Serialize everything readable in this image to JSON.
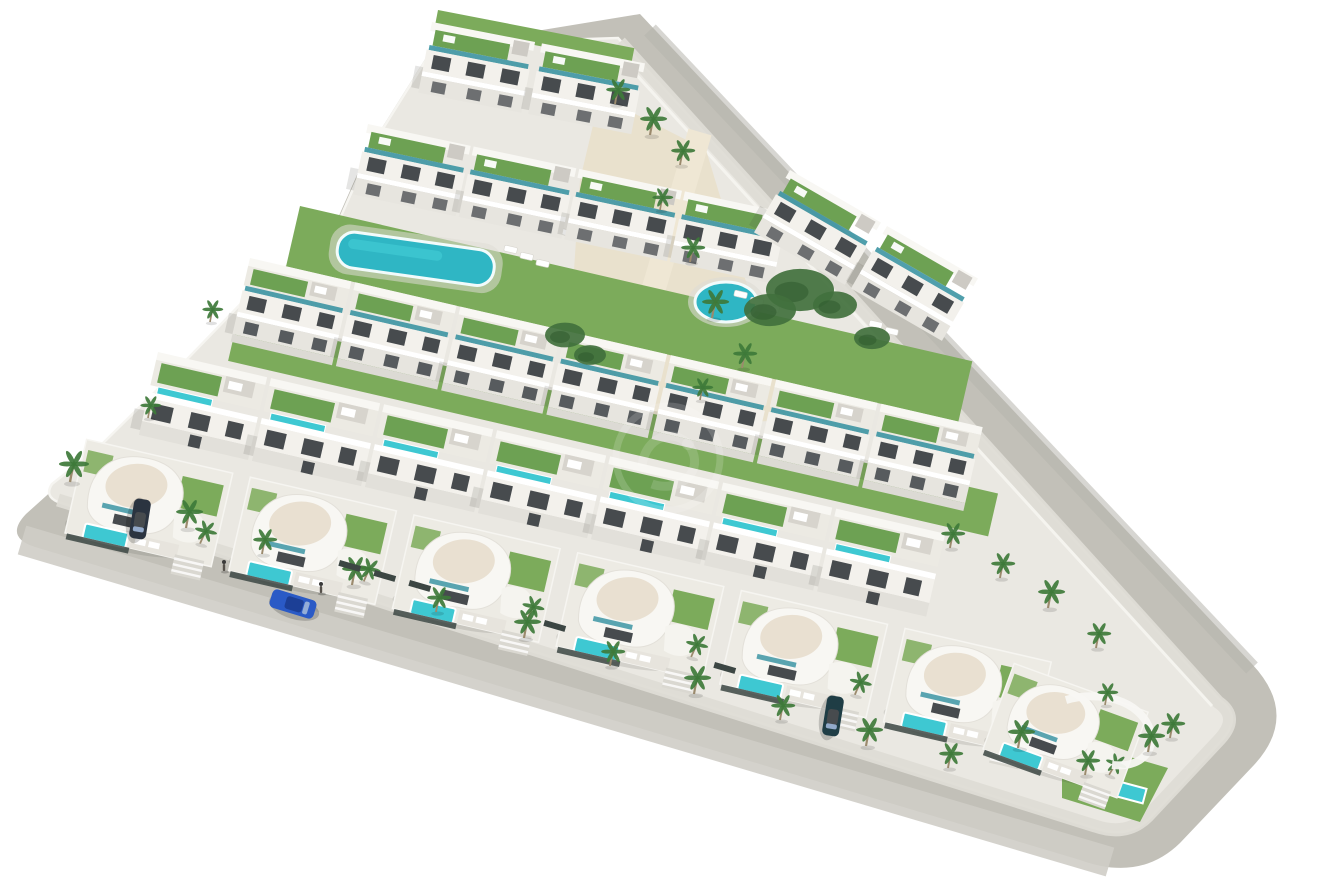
{
  "meta": {
    "title": "Aerial 3D architectural render of a triangular coastal residential development with white villas, green roof terraces, communal pools and perimeter roads",
    "canvas": {
      "w": 1320,
      "h": 895
    },
    "background": "#ffffff"
  },
  "palette": {
    "background": "#ffffff",
    "road_base": "#c2c0b8",
    "road_light": "#cfcdc6",
    "road_dark": "#b7b5ad",
    "sidewalk": "#dedcd5",
    "curb_white": "#f6f5f1",
    "platform": "#eae8e2",
    "building_white": "#f8f7f3",
    "facade_light": "#f3f1ec",
    "facade_mid": "#e7e5df",
    "facade_base": "#dcdad4",
    "stair_gray": "#cdcac4",
    "window_dark": "#474b4e",
    "window_mid": "#575b5e",
    "glass_teal": "#3d95a3",
    "roof_green": "#6da153",
    "lawn": "#7cab5b",
    "lawn_dark": "#41703d",
    "hedge_dark": "#3c4643",
    "pool": "#3ec8d2",
    "pool_deep": "#2fb6c4",
    "pool_rim": "#f2fbfb",
    "sand": "#e8dfc9",
    "walkway_sand": "#efe7d4",
    "cream_roof": "#e9e0d1",
    "palm_green": "#3e7a3a",
    "palm_trunk": "#9b8a6d",
    "car_blue_body": "#2a5ac6",
    "car_blue_roof": "#1c3f96",
    "car_glass": "#9fb6d8",
    "parked_car_1": "#2b3440",
    "parked_car_2": "#1f3d45",
    "shadow": "rgba(70,70,64,0.14)",
    "watermark": "#ffffff"
  },
  "scene": {
    "base": {
      "ring_outline": "M 640 14 L 1252 664 Q 1300 715 1254 765 L 1180 843 Q 1140 882 1080 860 L 35 547 Q 4 537 26 514 L 95 452 L 160 388 L 252 292 L 330 236 L 368 150 L 432 48 Z",
      "platform_outline": "M 618 38 L 1220 700 Q 1243 716 1222 740 L 1150 818 Q 1128 840 1094 828 L 58 502 Q 44 496 52 484 L 100 446 L 165 382 L 256 288 L 334 232 L 372 146 L 436 44 Z",
      "sidewalk_path": "M 620 42 L 1218 702 Q 1240 717 1220 739 L 1148 816 Q 1127 837 1095 826 L 58 500",
      "inner_wall_path": "M 612 48 L 1212 706",
      "road_bottom_overlay": "M 22 540 L 1110 862",
      "road_right_overlay": "M 650 30 L 1252 668"
    },
    "greens": [
      {
        "name": "communal-lawn-upper",
        "x": 300,
        "y": 206,
        "w": 690,
        "h": 62,
        "angle": 13
      },
      {
        "name": "communal-lawn-lower",
        "x": 238,
        "y": 318,
        "w": 780,
        "h": 44,
        "angle": 13
      },
      {
        "name": "roof-lawn-top",
        "x": 438,
        "y": 10,
        "w": 200,
        "h": 16,
        "angle": 11
      }
    ],
    "corner_lawn": "1062,737 1168,768 1140,822 1062,798",
    "plaza": "600,96 706,150 788,420 636,428 572,300 580,180",
    "walkway": {
      "d": "M 700 132 L 612 430",
      "width": 24
    },
    "pools": {
      "lap_pool": {
        "x": 340,
        "y": 230,
        "w": 158,
        "h": 36,
        "angle": 8
      },
      "round_pool": {
        "cx": 726,
        "cy": 302,
        "rx": 31,
        "ry": 20
      },
      "corner_pool": {
        "x": 1106,
        "y": 778,
        "w": 42,
        "h": 15,
        "angle": 15
      }
    },
    "rows": [
      {
        "name": "apartment-row-top",
        "style": "apartmentA",
        "origin": [
          432,
          22
        ],
        "angle": 11,
        "count": 2,
        "dx": 112
      },
      {
        "name": "apartment-row-upper",
        "style": "apartmentA",
        "origin": [
          368,
          124
        ],
        "angle": 12,
        "count": 4,
        "dx": 108
      },
      {
        "name": "apartment-row-roadside",
        "style": "apartmentA",
        "origin": [
          790,
          170
        ],
        "angle": 30,
        "count": 2,
        "dx": 112
      },
      {
        "name": "apartment-row-middle",
        "style": "apartmentB",
        "origin": [
          250,
          258
        ],
        "angle": 13,
        "count": 7,
        "dx": 108
      },
      {
        "name": "terrace-row",
        "style": "terrace",
        "origin": [
          158,
          352
        ],
        "angle": 13,
        "count": 7,
        "dx": 116
      },
      {
        "name": "villa-row",
        "style": "villa",
        "origin": [
          92,
          416
        ],
        "angle": 13,
        "count": 6,
        "dx": 168
      }
    ],
    "corner_villa": {
      "origin": [
        1022,
        642
      ],
      "angle": 20,
      "scale": 0.95
    },
    "corner_wall": "M 1066 700 C 1100 690 1140 700 1150 730 C 1156 752 1140 768 1112 765",
    "bushes": [
      [
        800,
        290,
        34
      ],
      [
        770,
        310,
        26
      ],
      [
        835,
        305,
        22
      ],
      [
        565,
        335,
        20
      ],
      [
        590,
        355,
        16
      ],
      [
        872,
        338,
        18
      ]
    ],
    "palms": [
      [
        70,
        482,
        1.0
      ],
      [
        186,
        528,
        0.9
      ],
      [
        262,
        554,
        0.8
      ],
      [
        352,
        585,
        0.9
      ],
      [
        436,
        612,
        0.8
      ],
      [
        524,
        638,
        0.9
      ],
      [
        610,
        666,
        0.8
      ],
      [
        694,
        694,
        0.9
      ],
      [
        780,
        720,
        0.8
      ],
      [
        866,
        746,
        0.9
      ],
      [
        948,
        768,
        0.8
      ],
      [
        1018,
        748,
        0.9
      ],
      [
        1085,
        775,
        0.8
      ],
      [
        1148,
        752,
        0.9
      ],
      [
        615,
        104,
        0.8
      ],
      [
        650,
        135,
        0.9
      ],
      [
        680,
        165,
        0.8
      ],
      [
        660,
        210,
        0.7
      ],
      [
        690,
        262,
        0.8
      ],
      [
        712,
        318,
        0.9
      ],
      [
        742,
        368,
        0.8
      ],
      [
        700,
        400,
        0.7
      ],
      [
        950,
        548,
        0.8
      ],
      [
        1000,
        578,
        0.8
      ],
      [
        1048,
        608,
        0.9
      ],
      [
        1096,
        648,
        0.8
      ],
      [
        1170,
        738,
        0.8
      ],
      [
        1105,
        705,
        0.7
      ],
      [
        210,
        322,
        0.7
      ],
      [
        148,
        418,
        0.7
      ]
    ],
    "loungers": [
      [
        505,
        245
      ],
      [
        521,
        252
      ],
      [
        537,
        259
      ],
      [
        735,
        290
      ],
      [
        751,
        297
      ],
      [
        767,
        304
      ],
      [
        560,
        228
      ],
      [
        870,
        320
      ],
      [
        886,
        327
      ]
    ],
    "fences": [
      [
        340,
        560
      ],
      [
        375,
        570
      ],
      [
        410,
        580
      ],
      [
        545,
        620
      ],
      [
        715,
        662
      ]
    ],
    "cars": [
      {
        "name": "car-blue-driving",
        "pos": [
          293,
          604
        ],
        "angle": 17,
        "len": 46,
        "wid": 19,
        "body": "car_blue_body",
        "roof": "car_blue_roof"
      },
      {
        "name": "parked-car-left",
        "pos": [
          140,
          519
        ],
        "angle": 99,
        "len": 40,
        "wid": 17,
        "body": "parked_car_1",
        "roof": "window_dark"
      },
      {
        "name": "parked-car-right",
        "pos": [
          833,
          716
        ],
        "angle": 99,
        "len": 40,
        "wid": 17,
        "body": "parked_car_2",
        "roof": "window_dark"
      }
    ],
    "pedestrians": [
      [
        224,
        566
      ],
      [
        321,
        588
      ]
    ],
    "watermark": {
      "cx": 668,
      "cy": 458,
      "r": 52,
      "opacity": 0.16
    }
  }
}
